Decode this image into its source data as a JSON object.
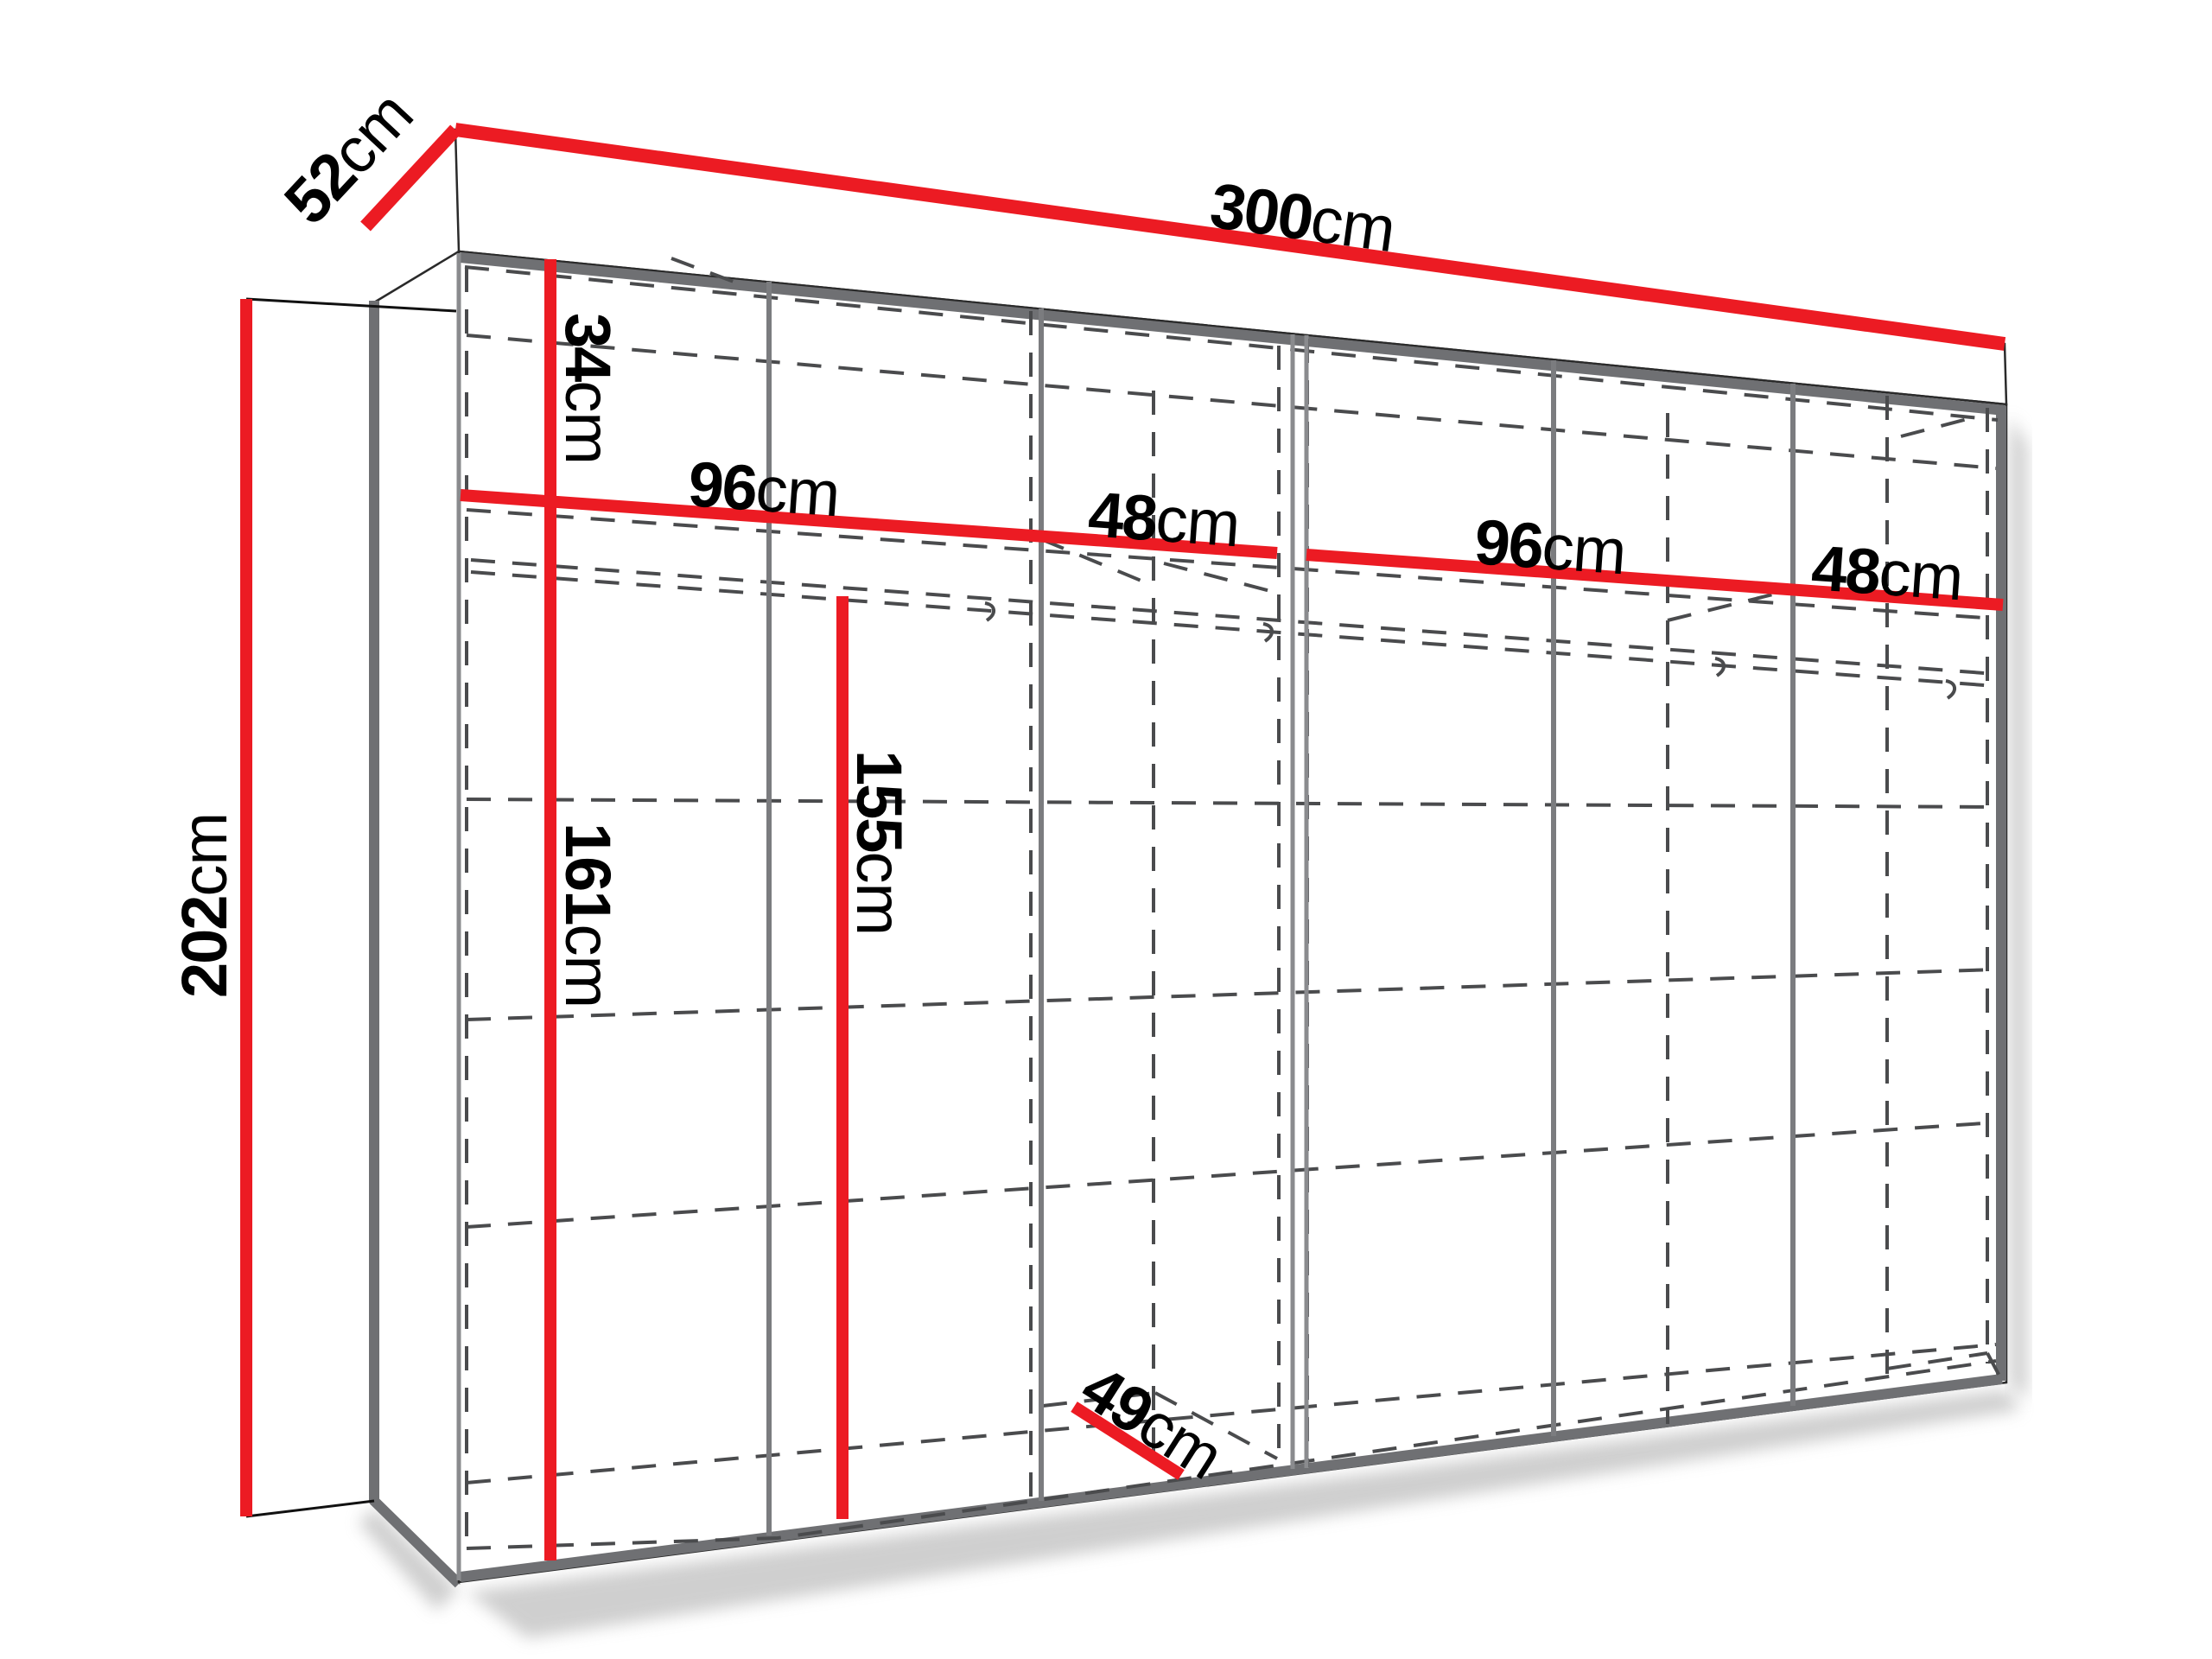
{
  "diagram": {
    "title": "wardrobe-dimensions-diagram",
    "unit": "cm",
    "colors": {
      "dimension_line": "#ec1b23",
      "edge_gray": "#6f7073",
      "dashed_line": "#4a4b4d",
      "text": "#000000",
      "background": "#ffffff"
    },
    "dimensions": {
      "width": {
        "value": "300",
        "unit": "cm"
      },
      "depth": {
        "value": "52",
        "unit": "cm"
      },
      "height": {
        "value": "202",
        "unit": "cm"
      },
      "top_shelf_height": {
        "value": "34",
        "unit": "cm"
      },
      "left_double_section_width": {
        "value": "96",
        "unit": "cm"
      },
      "left_single_section_width": {
        "value": "48",
        "unit": "cm"
      },
      "right_double_section_width": {
        "value": "96",
        "unit": "cm"
      },
      "right_single_section_width": {
        "value": "48",
        "unit": "cm"
      },
      "left_hanging_height": {
        "value": "161",
        "unit": "cm"
      },
      "right_hanging_height": {
        "value": "155",
        "unit": "cm"
      },
      "interior_depth": {
        "value": "49",
        "unit": "cm"
      }
    }
  }
}
